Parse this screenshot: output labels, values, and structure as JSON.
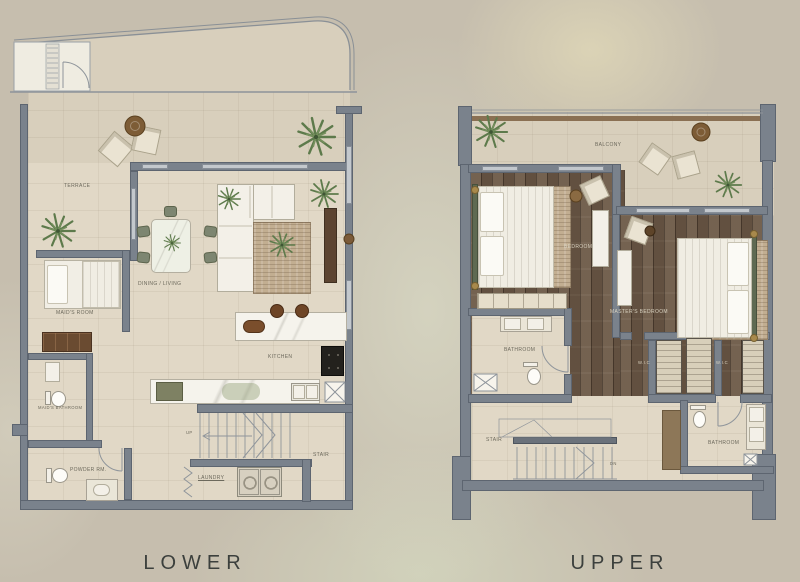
{
  "palette": {
    "background": "#c6beae",
    "wall": "#7a828c",
    "floor_tile": "#e1d8c6",
    "terrace_floor": "#d8cfbc",
    "wood_floor": "#6d5a48",
    "plant_green": "#5d7a4b",
    "label_text": "#6c695c",
    "caption_text": "#3c403d"
  },
  "floors": [
    {
      "name": "LOWER",
      "rooms": [
        {
          "label": "TERRACE"
        },
        {
          "label": "DINING / LIVING"
        },
        {
          "label": "KITCHEN"
        },
        {
          "label": "MAID'S ROOM"
        },
        {
          "label": "MAID'S BATHROOM"
        },
        {
          "label": "POWDER RM."
        },
        {
          "label": "STAIR"
        },
        {
          "label": "LAUNDRY"
        },
        {
          "label": "UP"
        }
      ]
    },
    {
      "name": "UPPER",
      "rooms": [
        {
          "label": "BALCONY"
        },
        {
          "label": "BEDROOM"
        },
        {
          "label": "MASTER'S BEDROOM"
        },
        {
          "label": "W.I.C"
        },
        {
          "label": "W.I.C"
        },
        {
          "label": "BATHROOM"
        },
        {
          "label": "BATHROOM"
        },
        {
          "label": "STAIR"
        },
        {
          "label": "DN"
        }
      ]
    }
  ]
}
